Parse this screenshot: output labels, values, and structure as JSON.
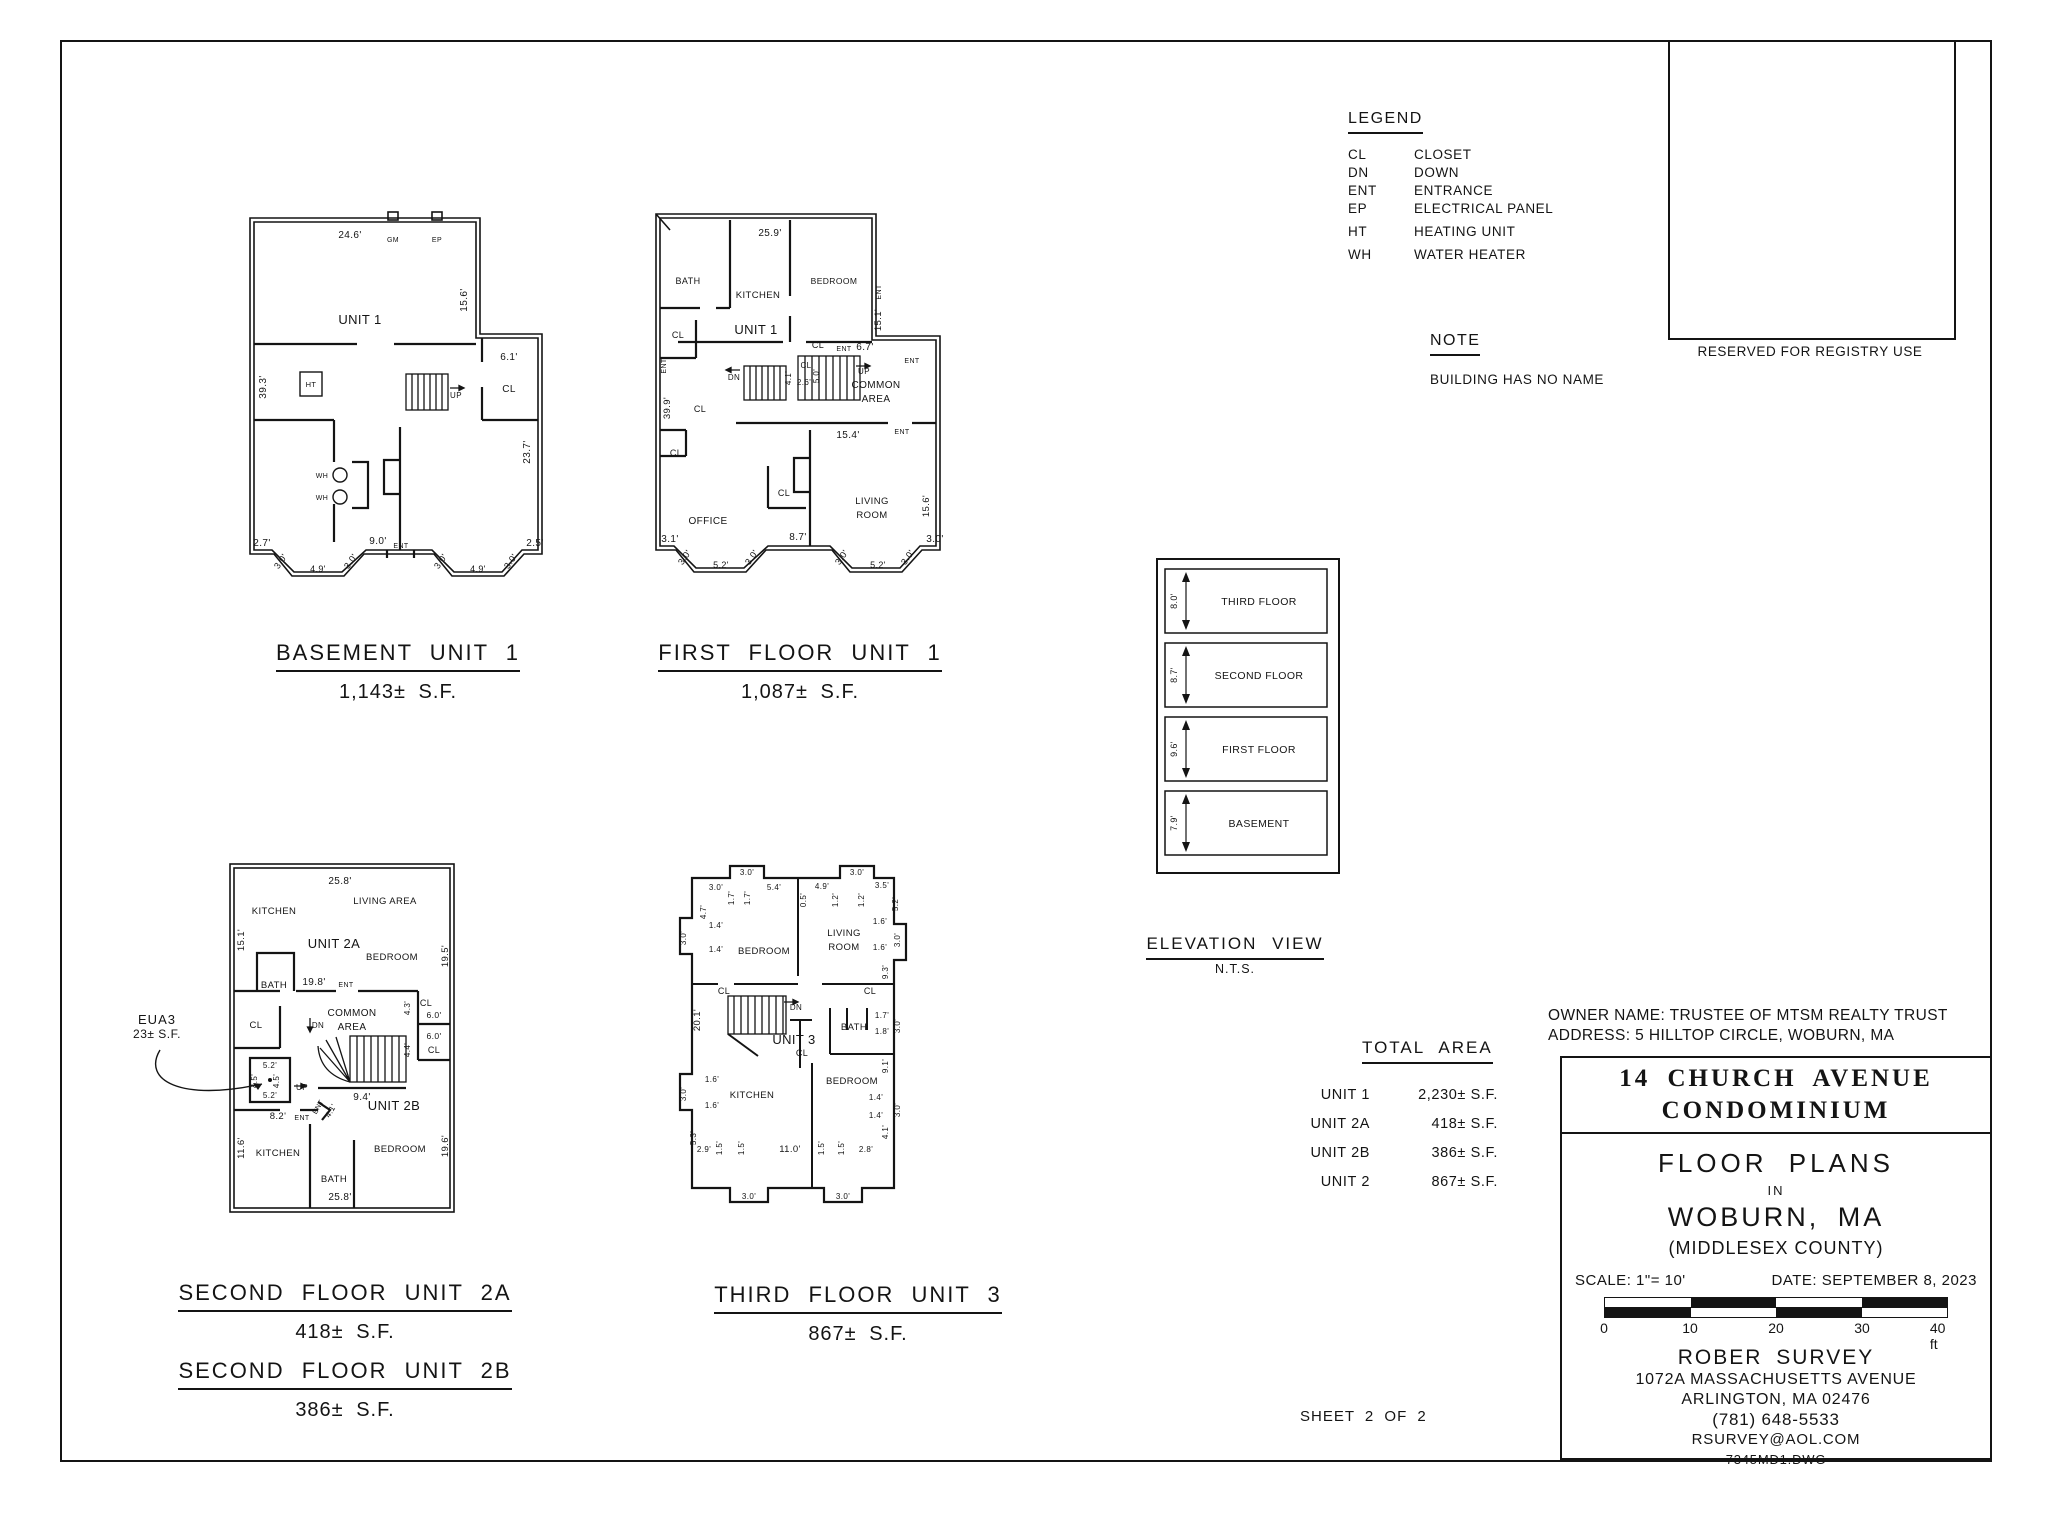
{
  "sheet": {
    "registry_label": "RESERVED FOR REGISTRY USE",
    "sheet_number": "SHEET 2 OF 2"
  },
  "legend": {
    "title": "LEGEND",
    "items": [
      {
        "abbr": "CL",
        "desc": "CLOSET"
      },
      {
        "abbr": "DN",
        "desc": "DOWN"
      },
      {
        "abbr": "ENT",
        "desc": "ENTRANCE"
      },
      {
        "abbr": "EP",
        "desc": "ELECTRICAL PANEL"
      },
      {
        "abbr": "HT",
        "desc": "HEATING UNIT"
      },
      {
        "abbr": "WH",
        "desc": "WATER HEATER"
      }
    ]
  },
  "note": {
    "title": "NOTE",
    "text": "BUILDING HAS NO NAME"
  },
  "elevation": {
    "title": "ELEVATION VIEW",
    "subtitle": "N.T.S.",
    "floors": [
      {
        "label": "THIRD FLOOR",
        "height": "8.0'"
      },
      {
        "label": "SECOND FLOOR",
        "height": "8.7'"
      },
      {
        "label": "FIRST FLOOR",
        "height": "9.6'"
      },
      {
        "label": "BASEMENT",
        "height": "7.9'"
      }
    ]
  },
  "total_area": {
    "title": "TOTAL AREA",
    "rows": [
      {
        "unit": "UNIT 1",
        "area": "2,230± S.F."
      },
      {
        "unit": "UNIT 2A",
        "area": "418± S.F."
      },
      {
        "unit": "UNIT 2B",
        "area": "386± S.F."
      },
      {
        "unit": "UNIT 2",
        "area": "867± S.F."
      }
    ]
  },
  "owner": {
    "name_line": "OWNER NAME: TRUSTEE OF MTSM REALTY TRUST",
    "address_line": "ADDRESS: 5 HILLTOP CIRCLE, WOBURN, MA"
  },
  "title_block": {
    "condo_line1": "14 CHURCH AVENUE",
    "condo_line2": "CONDOMINIUM",
    "doc_type": "FLOOR PLANS",
    "in_word": "IN",
    "city": "WOBURN, MA",
    "county": "(MIDDLESEX COUNTY)",
    "scale_label": "SCALE: 1\"= 10'",
    "date_label": "DATE: SEPTEMBER 8, 2023",
    "scale_ticks": [
      "0",
      "10",
      "20",
      "30",
      "40 ft"
    ],
    "surveyor": "ROBER SURVEY",
    "surveyor_address1": "1072A MASSACHUSETTS AVENUE",
    "surveyor_address2": "ARLINGTON, MA 02476",
    "surveyor_phone": "(781) 648-5533",
    "surveyor_email": "RSURVEY@AOL.COM",
    "drawing_file": "7345MD1.DWG"
  },
  "plan_titles": {
    "basement": {
      "title": "BASEMENT UNIT 1",
      "area": "1,143± S.F."
    },
    "first": {
      "title": "FIRST FLOOR UNIT 1",
      "area": "1,087± S.F."
    },
    "second_2a": {
      "title": "SECOND FLOOR UNIT 2A",
      "area": "418± S.F."
    },
    "second_2b": {
      "title": "SECOND FLOOR UNIT 2B",
      "area": "386± S.F."
    },
    "third": {
      "title": "THIRD FLOOR UNIT 3",
      "area": "867± S.F."
    }
  },
  "eua_callout": {
    "line1": "EUA3",
    "line2": "23± S.F."
  },
  "plan_labels": {
    "basement": [
      {
        "t": "24.6'",
        "x": 108,
        "y": 26,
        "s": 10
      },
      {
        "t": "GM",
        "x": 151,
        "y": 30,
        "s": 7
      },
      {
        "t": "EP",
        "x": 195,
        "y": 30,
        "s": 7
      },
      {
        "t": "UNIT 1",
        "x": 118,
        "y": 112,
        "s": 13
      },
      {
        "t": "15.6'",
        "x": 225,
        "y": 88,
        "r": -90,
        "s": 10
      },
      {
        "t": "39.3'",
        "x": 24,
        "y": 175,
        "r": -90,
        "s": 10
      },
      {
        "t": "6.1'",
        "x": 267,
        "y": 148,
        "s": 10
      },
      {
        "t": "CL",
        "x": 267,
        "y": 180,
        "s": 10
      },
      {
        "t": "HT",
        "x": 69,
        "y": 175,
        "s": 7.5
      },
      {
        "t": "UP",
        "x": 214,
        "y": 186,
        "s": 8
      },
      {
        "t": "WH",
        "x": 80,
        "y": 266,
        "s": 7
      },
      {
        "t": "WH",
        "x": 80,
        "y": 288,
        "s": 7
      },
      {
        "t": "23.7'",
        "x": 288,
        "y": 240,
        "r": -90,
        "s": 10
      },
      {
        "t": "2.7'",
        "x": 20,
        "y": 334,
        "s": 10
      },
      {
        "t": "3.0'",
        "x": 41,
        "y": 351,
        "r": -55,
        "s": 9
      },
      {
        "t": "4.9'",
        "x": 76,
        "y": 360,
        "s": 9
      },
      {
        "t": "3.0'",
        "x": 111,
        "y": 351,
        "r": -55,
        "s": 9
      },
      {
        "t": "9.0'",
        "x": 136,
        "y": 332,
        "s": 10
      },
      {
        "t": "ENT",
        "x": 159,
        "y": 336,
        "s": 7
      },
      {
        "t": "3.0'",
        "x": 201,
        "y": 351,
        "r": -55,
        "s": 9
      },
      {
        "t": "4.9'",
        "x": 236,
        "y": 360,
        "s": 9
      },
      {
        "t": "3.0'",
        "x": 271,
        "y": 351,
        "r": -55,
        "s": 9
      },
      {
        "t": "2.5'",
        "x": 293,
        "y": 334,
        "s": 10
      }
    ],
    "first": [
      {
        "t": "25.9'",
        "x": 122,
        "y": 28,
        "s": 10
      },
      {
        "t": "BATH",
        "x": 40,
        "y": 76,
        "s": 9
      },
      {
        "t": "KITCHEN",
        "x": 110,
        "y": 90,
        "s": 9.5
      },
      {
        "t": "BEDROOM",
        "x": 186,
        "y": 76,
        "s": 8.5
      },
      {
        "t": "ENT",
        "x": 233,
        "y": 84,
        "r": -90,
        "s": 7
      },
      {
        "t": "15.1'",
        "x": 233,
        "y": 112,
        "r": -90,
        "s": 9.5
      },
      {
        "t": "UNIT 1",
        "x": 108,
        "y": 126,
        "s": 13
      },
      {
        "t": "CL",
        "x": 30,
        "y": 130,
        "s": 9
      },
      {
        "t": "CL",
        "x": 170,
        "y": 140,
        "s": 9
      },
      {
        "t": "ENT",
        "x": 196,
        "y": 143,
        "s": 7
      },
      {
        "t": "6.7'",
        "x": 217,
        "y": 142,
        "s": 10
      },
      {
        "t": "ENT",
        "x": 264,
        "y": 155,
        "s": 7
      },
      {
        "t": "COMMON",
        "x": 228,
        "y": 180,
        "s": 10
      },
      {
        "t": "AREA",
        "x": 228,
        "y": 194,
        "s": 10
      },
      {
        "t": "CL",
        "x": 158,
        "y": 160,
        "s": 8
      },
      {
        "t": "5.0'",
        "x": 171,
        "y": 168,
        "r": -90,
        "s": 8
      },
      {
        "t": "2.6'",
        "x": 156,
        "y": 177,
        "s": 8
      },
      {
        "t": "ENT",
        "x": 18,
        "y": 158,
        "r": -90,
        "s": 7
      },
      {
        "t": "39.9'",
        "x": 22,
        "y": 200,
        "r": -90,
        "s": 9.5
      },
      {
        "t": "CL",
        "x": 52,
        "y": 204,
        "s": 9
      },
      {
        "t": "DN",
        "x": 86,
        "y": 172,
        "s": 8
      },
      {
        "t": "4.1'",
        "x": 143,
        "y": 170,
        "r": -90,
        "s": 8
      },
      {
        "t": "UP",
        "x": 216,
        "y": 166,
        "s": 8
      },
      {
        "t": "15.4'",
        "x": 200,
        "y": 230,
        "s": 10
      },
      {
        "t": "ENT",
        "x": 254,
        "y": 226,
        "s": 7
      },
      {
        "t": "CL",
        "x": 28,
        "y": 248,
        "s": 9
      },
      {
        "t": "CL",
        "x": 136,
        "y": 288,
        "s": 9
      },
      {
        "t": "OFFICE",
        "x": 60,
        "y": 316,
        "s": 10
      },
      {
        "t": "LIVING",
        "x": 224,
        "y": 296,
        "s": 9.5
      },
      {
        "t": "ROOM",
        "x": 224,
        "y": 310,
        "s": 9.5
      },
      {
        "t": "15.6'",
        "x": 281,
        "y": 298,
        "r": -90,
        "s": 9.5
      },
      {
        "t": "3.1'",
        "x": 22,
        "y": 334,
        "s": 10
      },
      {
        "t": "3.0'",
        "x": 39,
        "y": 351,
        "r": -55,
        "s": 9
      },
      {
        "t": "5.2'",
        "x": 73,
        "y": 360,
        "s": 9
      },
      {
        "t": "3.0'",
        "x": 106,
        "y": 351,
        "r": -55,
        "s": 9
      },
      {
        "t": "8.7'",
        "x": 150,
        "y": 332,
        "s": 10
      },
      {
        "t": "3.0'",
        "x": 196,
        "y": 351,
        "r": -55,
        "s": 9
      },
      {
        "t": "5.2'",
        "x": 230,
        "y": 360,
        "s": 9
      },
      {
        "t": "3.0'",
        "x": 262,
        "y": 351,
        "r": -55,
        "s": 9
      },
      {
        "t": "3.0'",
        "x": 287,
        "y": 334,
        "s": 10
      }
    ],
    "second": [
      {
        "t": "25.8'",
        "x": 118,
        "y": 26,
        "s": 10
      },
      {
        "t": "KITCHEN",
        "x": 52,
        "y": 56,
        "s": 9.5
      },
      {
        "t": "LIVING AREA",
        "x": 163,
        "y": 46,
        "s": 9.5
      },
      {
        "t": "15.1'",
        "x": 22,
        "y": 82,
        "r": -90,
        "s": 9.5
      },
      {
        "t": "UNIT 2A",
        "x": 112,
        "y": 90,
        "s": 13
      },
      {
        "t": "BEDROOM",
        "x": 170,
        "y": 102,
        "s": 9.5
      },
      {
        "t": "19.5'",
        "x": 226,
        "y": 98,
        "r": -90,
        "s": 9.5
      },
      {
        "t": "BATH",
        "x": 52,
        "y": 130,
        "s": 9.5
      },
      {
        "t": "19.8'",
        "x": 92,
        "y": 127,
        "s": 10
      },
      {
        "t": "ENT",
        "x": 124,
        "y": 129,
        "s": 7
      },
      {
        "t": "COMMON",
        "x": 130,
        "y": 158,
        "s": 10
      },
      {
        "t": "AREA",
        "x": 130,
        "y": 172,
        "s": 10
      },
      {
        "t": "DN",
        "x": 96,
        "y": 170,
        "s": 8
      },
      {
        "t": "CL",
        "x": 204,
        "y": 148,
        "s": 9
      },
      {
        "t": "4.3'",
        "x": 188,
        "y": 150,
        "r": -90,
        "s": 8
      },
      {
        "t": "6.0'",
        "x": 212,
        "y": 160,
        "s": 8.5
      },
      {
        "t": "6.0'",
        "x": 212,
        "y": 181,
        "s": 8.5
      },
      {
        "t": "4.4'",
        "x": 188,
        "y": 192,
        "r": -90,
        "s": 8
      },
      {
        "t": "CL",
        "x": 212,
        "y": 195,
        "s": 9
      },
      {
        "t": "CL",
        "x": 34,
        "y": 170,
        "s": 9.5
      },
      {
        "t": "5.2'",
        "x": 48,
        "y": 210,
        "s": 8
      },
      {
        "t": "4.5'",
        "x": 35,
        "y": 223,
        "r": -90,
        "s": 8
      },
      {
        "t": "4.5'",
        "x": 57,
        "y": 223,
        "r": -90,
        "s": 8
      },
      {
        "t": "5.2'",
        "x": 48,
        "y": 240,
        "s": 8
      },
      {
        "t": "UP",
        "x": 80,
        "y": 232,
        "s": 8
      },
      {
        "t": "9.4'",
        "x": 140,
        "y": 242,
        "s": 10
      },
      {
        "t": "ENT",
        "x": 98,
        "y": 250,
        "r": -60,
        "s": 7
      },
      {
        "t": "4.1'",
        "x": 111,
        "y": 254,
        "r": -60,
        "s": 8
      },
      {
        "t": "8.2'",
        "x": 56,
        "y": 261,
        "s": 9.5
      },
      {
        "t": "ENT",
        "x": 80,
        "y": 262,
        "s": 7
      },
      {
        "t": "UNIT 2B",
        "x": 172,
        "y": 252,
        "s": 13
      },
      {
        "t": "11.6'",
        "x": 22,
        "y": 290,
        "r": -90,
        "s": 9.5
      },
      {
        "t": "KITCHEN",
        "x": 56,
        "y": 298,
        "s": 9.5
      },
      {
        "t": "BATH",
        "x": 112,
        "y": 324,
        "s": 9.5
      },
      {
        "t": "BEDROOM",
        "x": 178,
        "y": 294,
        "s": 9.5
      },
      {
        "t": "19.6'",
        "x": 226,
        "y": 288,
        "r": -90,
        "s": 9.5
      },
      {
        "t": "25.8'",
        "x": 118,
        "y": 342,
        "s": 10
      }
    ],
    "third": [
      {
        "t": "3.0'",
        "x": 75,
        "y": 17,
        "s": 8
      },
      {
        "t": "3.0'",
        "x": 185,
        "y": 17,
        "s": 8
      },
      {
        "t": "3.0'",
        "x": 44,
        "y": 32,
        "s": 8
      },
      {
        "t": "1.7'",
        "x": 62,
        "y": 40,
        "r": -90,
        "s": 8
      },
      {
        "t": "1.7'",
        "x": 78,
        "y": 40,
        "r": -90,
        "s": 8
      },
      {
        "t": "5.4'",
        "x": 102,
        "y": 32,
        "s": 8
      },
      {
        "t": "0.5'",
        "x": 134,
        "y": 42,
        "r": -90,
        "s": 8
      },
      {
        "t": "4.9'",
        "x": 150,
        "y": 31,
        "s": 8
      },
      {
        "t": "1.2'",
        "x": 166,
        "y": 42,
        "r": -90,
        "s": 8
      },
      {
        "t": "1.2'",
        "x": 192,
        "y": 42,
        "r": -90,
        "s": 8
      },
      {
        "t": "3.5'",
        "x": 210,
        "y": 30,
        "s": 8
      },
      {
        "t": "5.2'",
        "x": 226,
        "y": 46,
        "r": -90,
        "s": 8
      },
      {
        "t": "3.0'",
        "x": 14,
        "y": 80,
        "r": -90,
        "s": 8
      },
      {
        "t": "4.7'",
        "x": 34,
        "y": 54,
        "r": -90,
        "s": 8
      },
      {
        "t": "1.4'",
        "x": 44,
        "y": 70,
        "s": 8
      },
      {
        "t": "1.4'",
        "x": 44,
        "y": 94,
        "s": 8
      },
      {
        "t": "BEDROOM",
        "x": 92,
        "y": 96,
        "s": 9.5
      },
      {
        "t": "LIVING",
        "x": 172,
        "y": 78,
        "s": 9.5
      },
      {
        "t": "ROOM",
        "x": 172,
        "y": 92,
        "s": 9.5
      },
      {
        "t": "1.6'",
        "x": 208,
        "y": 66,
        "s": 8
      },
      {
        "t": "3.0'",
        "x": 228,
        "y": 82,
        "r": -90,
        "s": 8
      },
      {
        "t": "1.6'",
        "x": 208,
        "y": 92,
        "s": 8
      },
      {
        "t": "9.3'",
        "x": 216,
        "y": 114,
        "r": -90,
        "s": 8
      },
      {
        "t": "CL",
        "x": 52,
        "y": 136,
        "s": 9
      },
      {
        "t": "CL",
        "x": 198,
        "y": 136,
        "s": 9
      },
      {
        "t": "20.1'",
        "x": 28,
        "y": 162,
        "r": -90,
        "s": 9.5
      },
      {
        "t": "DN",
        "x": 124,
        "y": 152,
        "s": 8
      },
      {
        "t": "UNIT 3",
        "x": 122,
        "y": 186,
        "s": 13
      },
      {
        "t": "BATH",
        "x": 182,
        "y": 172,
        "s": 9.5
      },
      {
        "t": "1.7'",
        "x": 210,
        "y": 160,
        "s": 8
      },
      {
        "t": "1.8'",
        "x": 210,
        "y": 176,
        "s": 8
      },
      {
        "t": "3.0'",
        "x": 228,
        "y": 168,
        "r": -90,
        "s": 8
      },
      {
        "t": "9.1'",
        "x": 216,
        "y": 208,
        "r": -90,
        "s": 8
      },
      {
        "t": "CL",
        "x": 130,
        "y": 198,
        "s": 9
      },
      {
        "t": "BEDROOM",
        "x": 180,
        "y": 226,
        "s": 9.5
      },
      {
        "t": "KITCHEN",
        "x": 80,
        "y": 240,
        "s": 9.5
      },
      {
        "t": "1.6'",
        "x": 40,
        "y": 224,
        "s": 8
      },
      {
        "t": "3.0'",
        "x": 14,
        "y": 236,
        "r": -90,
        "s": 8
      },
      {
        "t": "1.6'",
        "x": 40,
        "y": 250,
        "s": 8
      },
      {
        "t": "1.4'",
        "x": 204,
        "y": 242,
        "s": 8
      },
      {
        "t": "1.4'",
        "x": 204,
        "y": 260,
        "s": 8
      },
      {
        "t": "3.0'",
        "x": 228,
        "y": 252,
        "r": -90,
        "s": 8
      },
      {
        "t": "4.1'",
        "x": 216,
        "y": 274,
        "r": -90,
        "s": 8
      },
      {
        "t": "5.3'",
        "x": 24,
        "y": 280,
        "r": -90,
        "s": 8
      },
      {
        "t": "2.9'",
        "x": 32,
        "y": 294,
        "s": 8
      },
      {
        "t": "1.5'",
        "x": 50,
        "y": 290,
        "r": -90,
        "s": 8
      },
      {
        "t": "1.5'",
        "x": 72,
        "y": 290,
        "r": -90,
        "s": 8
      },
      {
        "t": "11.0'",
        "x": 118,
        "y": 294,
        "s": 9.5
      },
      {
        "t": "1.5'",
        "x": 152,
        "y": 290,
        "r": -90,
        "s": 8
      },
      {
        "t": "1.5'",
        "x": 172,
        "y": 290,
        "r": -90,
        "s": 8
      },
      {
        "t": "2.8'",
        "x": 194,
        "y": 294,
        "s": 8
      },
      {
        "t": "3.0'",
        "x": 77,
        "y": 341,
        "s": 8
      },
      {
        "t": "3.0'",
        "x": 171,
        "y": 341,
        "s": 8
      }
    ]
  }
}
